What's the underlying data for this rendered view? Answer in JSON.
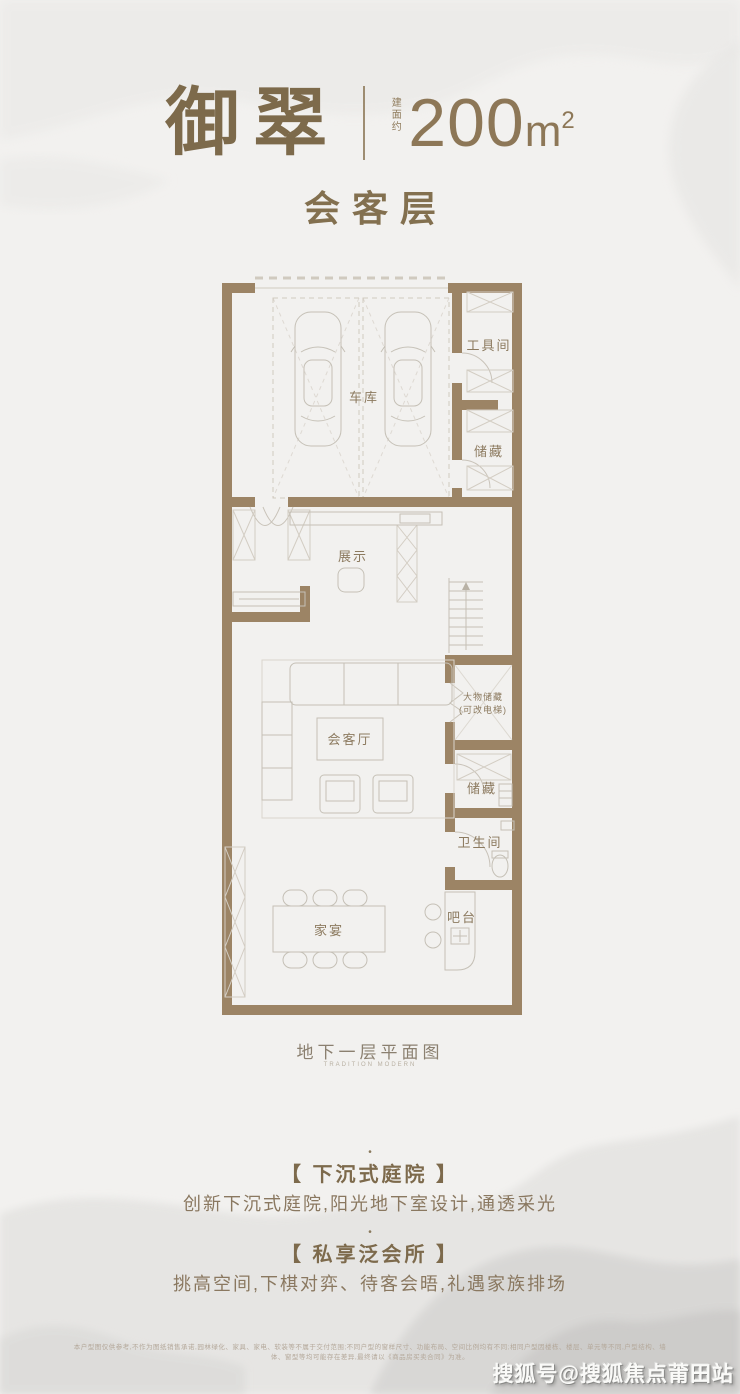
{
  "header": {
    "brand": "御翠",
    "area_label": "建面约",
    "area_value": "200",
    "area_unit": "m",
    "area_exp": "2",
    "floor": "会客层"
  },
  "plan": {
    "rooms": [
      {
        "id": "tool-room",
        "label": "工具间"
      },
      {
        "id": "garage",
        "label": "车库"
      },
      {
        "id": "storage-upper",
        "label": "储藏"
      },
      {
        "id": "display",
        "label": "展示"
      },
      {
        "id": "large-storage",
        "label": "大物储藏",
        "label2": "(可改电梯)"
      },
      {
        "id": "reception-hall",
        "label": "会客厅"
      },
      {
        "id": "storage-lower",
        "label": "储藏"
      },
      {
        "id": "bathroom",
        "label": "卫生间"
      },
      {
        "id": "family-dining",
        "label": "家宴"
      },
      {
        "id": "bar",
        "label": "吧台"
      }
    ],
    "caption": "地下一层平面图",
    "caption_sub": "TRADITION MODERN"
  },
  "features": [
    {
      "bullet": "•",
      "title": "【 下沉式庭院 】",
      "desc": "创新下沉式庭院,阳光地下室设计,通透采光"
    },
    {
      "bullet": "•",
      "title": "【 私享泛会所 】",
      "desc": "挑高空间,下棋对弈、待客会晤,礼遇家族排场"
    }
  ],
  "disclaimer": "本户型图仅供参考,不作为图纸销售承诺,园林绿化、家具、家电、软装等不属于交付范围;不同户型的窗样尺寸、功能布局、空间比例均有不同;相同户型因楼栋、楼层、单元等不同,户型结构、墙体、窗型等均可能存在差异,最终请以《商品房买卖合同》为准。",
  "watermark": "搜狐号@搜狐焦点莆田站",
  "colors": {
    "accent": "#8b7758",
    "wall": "#9c8465",
    "label": "#8c7a5f"
  }
}
